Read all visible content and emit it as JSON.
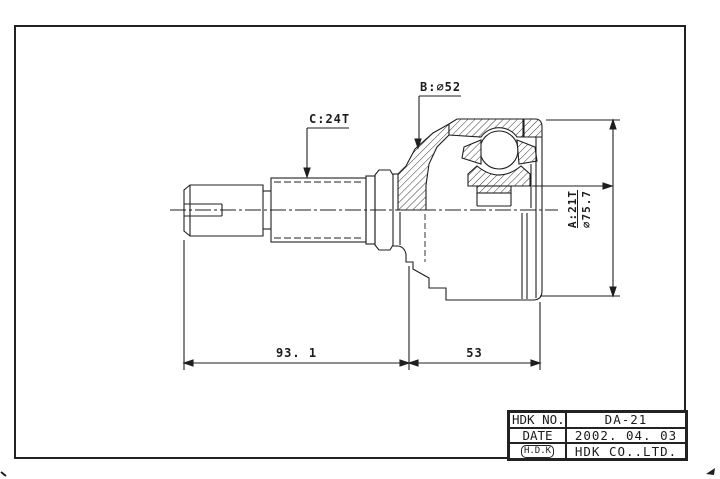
{
  "page": {
    "paper_color": "#ffffff",
    "ink_color": "#1f1f1f"
  },
  "drawing": {
    "type": "engineering-drawing",
    "subject": "constant-velocity joint (outboard CV joint) side section view",
    "labels": {
      "spline_c": "C:24T",
      "diameter_b": "B:⌀52",
      "spline_a": "A:21T",
      "diameter_a": "⌀75.7",
      "dim_shaft_length": "93. 1",
      "dim_housing_length": "53"
    }
  },
  "title_block": {
    "rows": [
      {
        "label": "HDK NO.",
        "value": "DA-21"
      },
      {
        "label": "DATE",
        "value": "2002. 04. 03"
      },
      {
        "label": "H.D.K",
        "value": "HDK CO..LTD."
      }
    ]
  }
}
